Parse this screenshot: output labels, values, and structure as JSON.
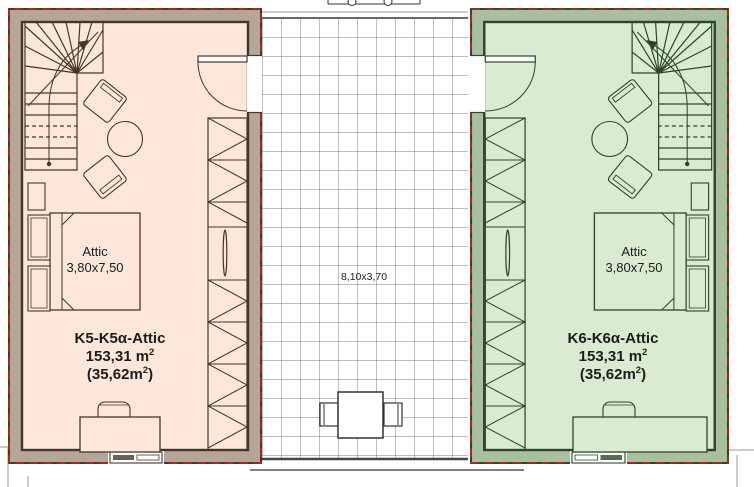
{
  "units": {
    "left": {
      "room_label": "Attic",
      "room_size": "3,80x7,50",
      "unit_label": "K5-K5α-Attic",
      "area_total": "153,31 m",
      "area_total_sup": "2",
      "area_sub_open": "(35,62m",
      "area_sub_sup": "2",
      "area_sub_close": ")",
      "colors": {
        "wall": "#b5a699",
        "floor": "#fce7da",
        "line": "#46362a"
      }
    },
    "right": {
      "room_label": "Attic",
      "room_size": "3,80x7,50",
      "unit_label": "K6-K6α-Attic",
      "area_total": "153,31 m",
      "area_total_sup": "2",
      "area_sub_open": "(35,62m",
      "area_sub_sup": "2",
      "area_sub_close": ")",
      "colors": {
        "wall": "#a8c0a0",
        "floor": "#d9ecd2",
        "line": "#2d4628"
      }
    }
  },
  "terrace": {
    "size_label": "8,10x3,70",
    "grid_color": "#7d7d7d"
  },
  "boundary_color": "#9c2d1e"
}
